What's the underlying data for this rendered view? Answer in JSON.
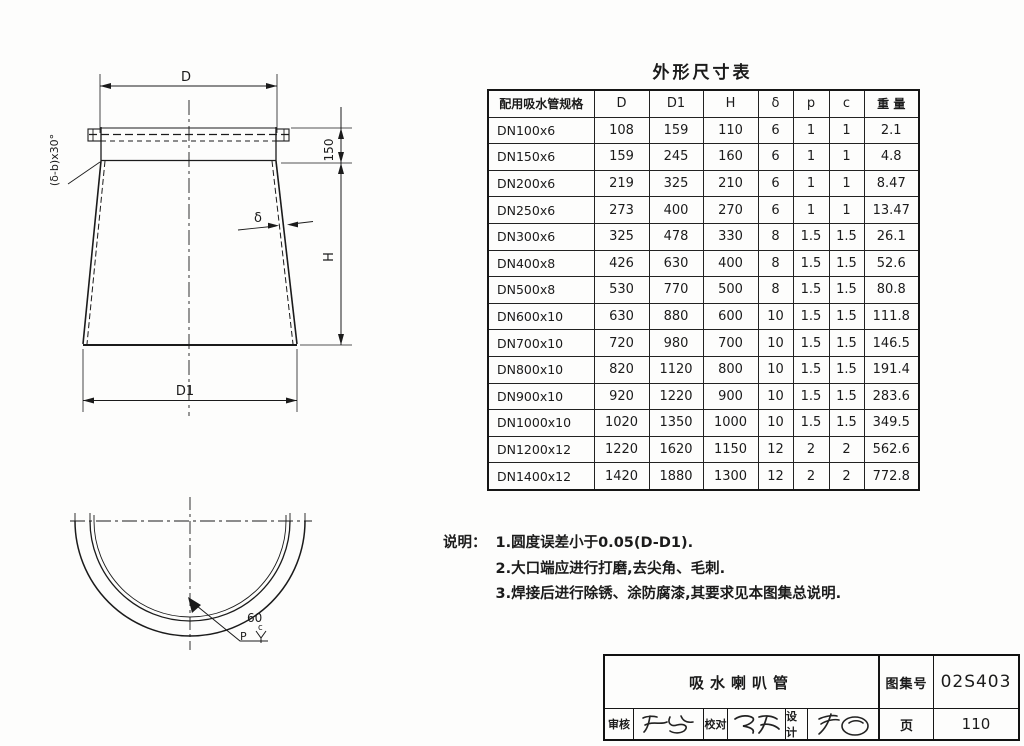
{
  "drawing": {
    "top_view": {
      "dim_d": "D",
      "dim_d1": "D1",
      "dim_h": "H",
      "dim_150": "150",
      "dim_delta": "δ",
      "chamfer_label": "(δ-b)x30°"
    },
    "bottom_view": {
      "dim_60": "60",
      "weld_p": "P",
      "weld_c": "c"
    }
  },
  "table": {
    "title": "外形尺寸表",
    "columns": [
      "配用吸水管规格",
      "D",
      "D1",
      "H",
      "δ",
      "p",
      "c",
      "重 量"
    ],
    "rows": [
      [
        "DN100x6",
        "108",
        "159",
        "110",
        "6",
        "1",
        "1",
        "2.1"
      ],
      [
        "DN150x6",
        "159",
        "245",
        "160",
        "6",
        "1",
        "1",
        "4.8"
      ],
      [
        "DN200x6",
        "219",
        "325",
        "210",
        "6",
        "1",
        "1",
        "8.47"
      ],
      [
        "DN250x6",
        "273",
        "400",
        "270",
        "6",
        "1",
        "1",
        "13.47"
      ],
      [
        "DN300x6",
        "325",
        "478",
        "330",
        "8",
        "1.5",
        "1.5",
        "26.1"
      ],
      [
        "DN400x8",
        "426",
        "630",
        "400",
        "8",
        "1.5",
        "1.5",
        "52.6"
      ],
      [
        "DN500x8",
        "530",
        "770",
        "500",
        "8",
        "1.5",
        "1.5",
        "80.8"
      ],
      [
        "DN600x10",
        "630",
        "880",
        "600",
        "10",
        "1.5",
        "1.5",
        "111.8"
      ],
      [
        "DN700x10",
        "720",
        "980",
        "700",
        "10",
        "1.5",
        "1.5",
        "146.5"
      ],
      [
        "DN800x10",
        "820",
        "1120",
        "800",
        "10",
        "1.5",
        "1.5",
        "191.4"
      ],
      [
        "DN900x10",
        "920",
        "1220",
        "900",
        "10",
        "1.5",
        "1.5",
        "283.6"
      ],
      [
        "DN1000x10",
        "1020",
        "1350",
        "1000",
        "10",
        "1.5",
        "1.5",
        "349.5"
      ],
      [
        "DN1200x12",
        "1220",
        "1620",
        "1150",
        "12",
        "2",
        "2",
        "562.6"
      ],
      [
        "DN1400x12",
        "1420",
        "1880",
        "1300",
        "12",
        "2",
        "2",
        "772.8"
      ]
    ]
  },
  "notes": {
    "label": "说明：",
    "items": [
      "1.圆度误差小于0.05(D-D1).",
      "2.大口端应进行打磨,去尖角、毛刺.",
      "3.焊接后进行除锈、涂防腐漆,其要求见本图集总说明."
    ]
  },
  "title_block": {
    "drawing_title": "吸水喇叭管",
    "atlas_no_label": "图集号",
    "atlas_no_value": "02S403",
    "review_label": "审核",
    "check_label": "校对",
    "design_label": "设计",
    "page_label": "页",
    "page_value": "110"
  },
  "colors": {
    "line": "#1b1b1b",
    "background": "#fdfdfc"
  }
}
